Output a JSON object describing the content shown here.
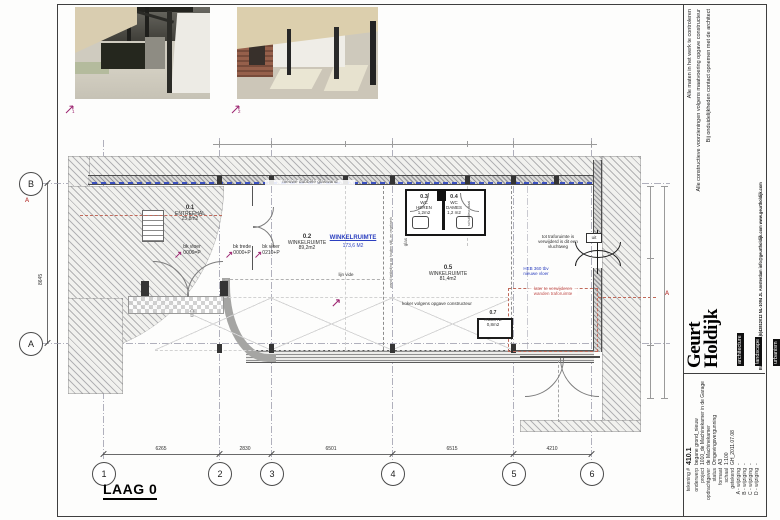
{
  "colors": {
    "accent_blue": "#2b3fbf",
    "annotation_orange": "#c0504d",
    "marker_magenta": "#9c2470",
    "wall_gray": "#97979b"
  },
  "icons": {
    "north_arrow": "⇧"
  },
  "renders": {
    "marker1": "1",
    "marker2": "2"
  },
  "plan": {
    "title": "LAAG 0",
    "grid_cols": [
      "1",
      "2",
      "3",
      "4",
      "5",
      "6"
    ],
    "grid_rows": [
      "B",
      "A"
    ],
    "dims_bottom": [
      "6265",
      "2830",
      "6501",
      "6515",
      "4210"
    ],
    "dim_left": "8645",
    "section_label": "A",
    "rooms": {
      "r01": {
        "no": "0.1",
        "name": "ENTREEHAL",
        "area": "25,8m2"
      },
      "r02": {
        "no": "0.2",
        "name": "WINKELRUIMTE",
        "area": "89,2m2"
      },
      "r03": {
        "no": "0.3",
        "name": "WC",
        "name2": "HEREN",
        "area": "1,2m2"
      },
      "r04": {
        "no": "0.4",
        "name": "WC",
        "name2": "DAMES",
        "area": "1,2 m2"
      },
      "r05": {
        "no": "0.5",
        "name": "WINKELRUIMTE",
        "area": "81,4m2"
      },
      "r07": {
        "no": "0.7",
        "name": "RUIMTE",
        "area": "0,8m2"
      }
    },
    "blue_label": {
      "name": "WINKELRUIMTE",
      "area": "173,6 M2"
    },
    "ann": {
      "glaswand": "nieuwe dubbele glaswand",
      "bkvloer1a": "bk vloer",
      "bkvloer1b": "0000=P",
      "bktredea": "bk trede",
      "bktredeb": "0000+P",
      "bkvloer2a": "bk vloer",
      "bkvloer2b": "0210+P",
      "vlucht": "tot traforuimte is verwijderd is dit een vluchtweg",
      "heb": "HEB 360 tbv nieuwe vloer",
      "trafo": "later te verwijderen wanden traforuimte",
      "koker": "koker volgens opgave constructeur",
      "lijnvide": "lijn vide",
      "glas": "glas",
      "wand": "wand bekleding op houten stijl- en regelwerk",
      "schuif": "schuifdeur staal",
      "uit": "uit"
    }
  },
  "titleblock": {
    "disclaimers": [
      "Alle maten in het werk te controleren",
      "Alle constructieve voorzieningen volgens maatvoering opgave constructeur",
      "Bij onduidelijkheden contact opnemen met de architect"
    ],
    "logo_line1": "Geurt",
    "logo_line2": "Holdijk",
    "tags": [
      "architecture",
      "landscape",
      "urbanism"
    ],
    "address": "Balistraat 16a    +31|6|42812012    NL-1094 JL    Amsterdam    info@geurtholdijk.com    www.geurtholdijk.com",
    "fields": [
      {
        "label": "tekening #",
        "value": "410.1"
      },
      {
        "label": "onderwerp",
        "value": "begane grond_nieuw"
      },
      {
        "label": "project",
        "value": "1010_de Machinekamer in de Garage"
      },
      {
        "label": "opdrachtgever",
        "value": "de Machinekamer"
      },
      {
        "label": "status",
        "value": "Omgevingsvergunning"
      },
      {
        "label": "formaat",
        "value": "A3"
      },
      {
        "label": "schaal",
        "value": "1:100"
      },
      {
        "label": "getekend",
        "value": "GH_2011.07.08"
      },
      {
        "label": "A - wijziging",
        "value": "-"
      },
      {
        "label": "B - wijziging",
        "value": "-"
      },
      {
        "label": "C - wijziging",
        "value": "-"
      },
      {
        "label": "D - wijziging",
        "value": "-"
      }
    ]
  }
}
